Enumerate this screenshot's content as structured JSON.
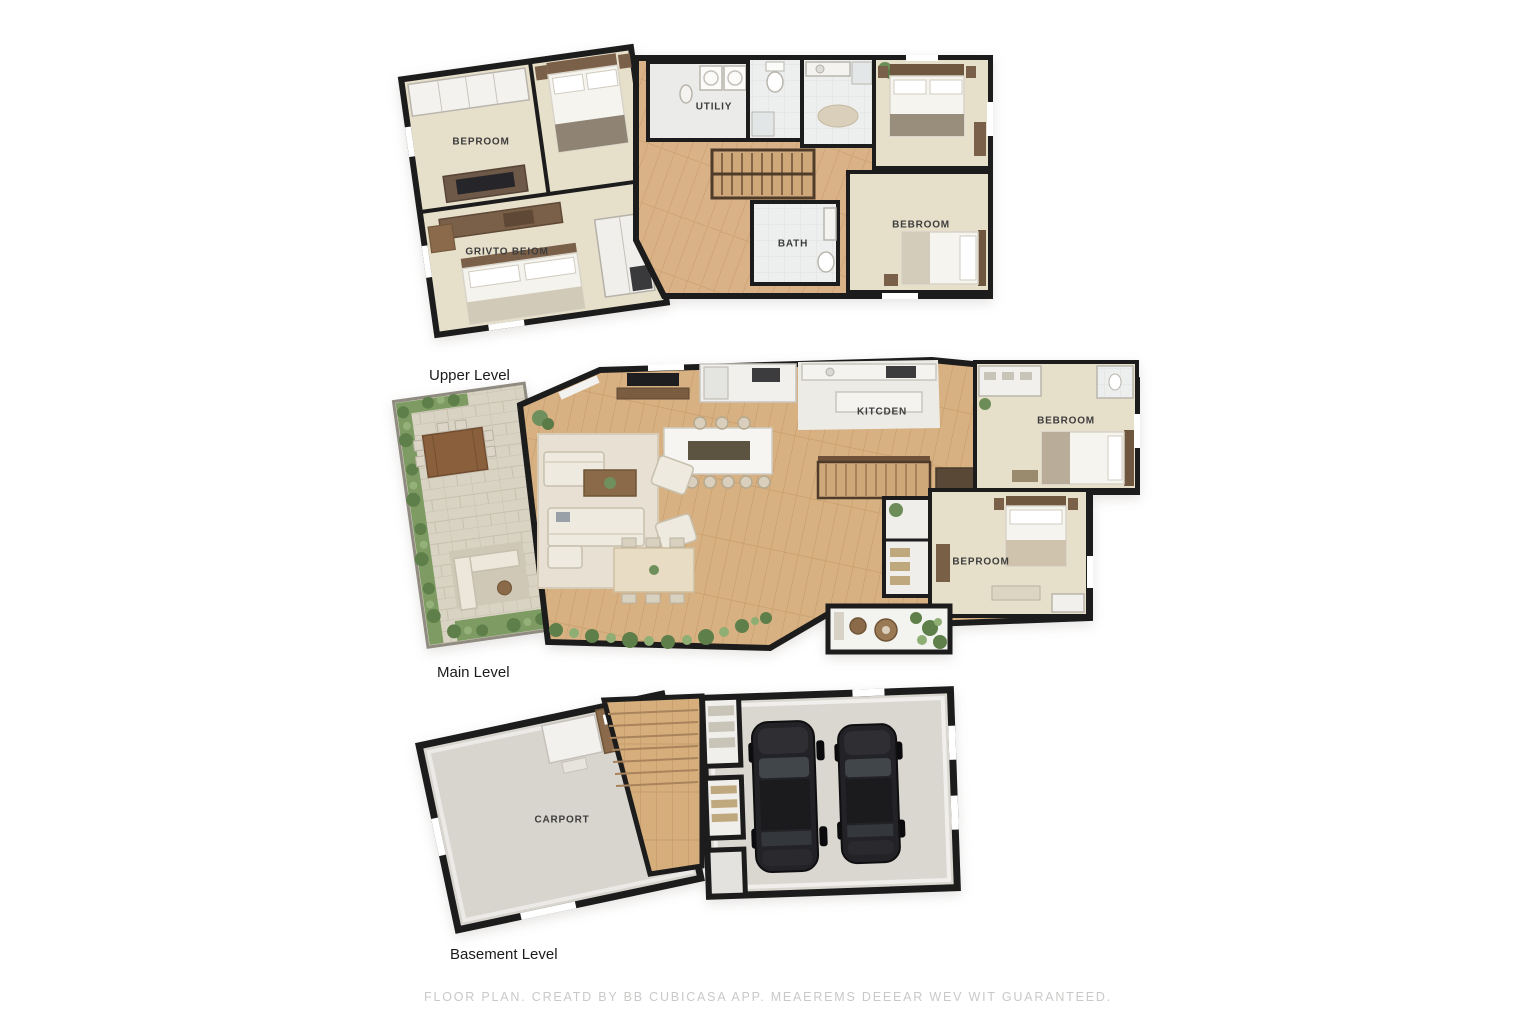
{
  "page": {
    "background": "#ffffff"
  },
  "labels": {
    "upper_title": "Upper Level",
    "main_title": "Main Level",
    "basement_title": "Basement Level",
    "footer": "FLOOR PLAN. CREATD BY BB CUBICASA APP. MEAEREMS DEEEAR WEV WIT GUARANTEED."
  },
  "rooms": {
    "upper_bedroom": "BEPROOM",
    "upper_utility": "UTILIY",
    "upper_primary": "GRIVTO BEIOM",
    "upper_bath": "BATH",
    "upper_bedroom_right": "BEBROOM",
    "main_kitchen": "KITCDEN",
    "main_bedroom_upper": "BEBROOM",
    "main_bedroom_lower": "BEPROOM",
    "basement_carport": "CARPORT"
  },
  "palette": {
    "wall": "#1c1c1c",
    "wood_floor": "#d9b286",
    "carpet": "#e6dfca",
    "tile": "#edefee",
    "stone_patio": "#d9d3c4",
    "concrete": "#d8d5ce",
    "plants": "#7d9b63",
    "car": "#232327",
    "label_text": "#3d3d3d",
    "title_text": "#1b1b1b",
    "footer_text": "#c9c9c8"
  }
}
